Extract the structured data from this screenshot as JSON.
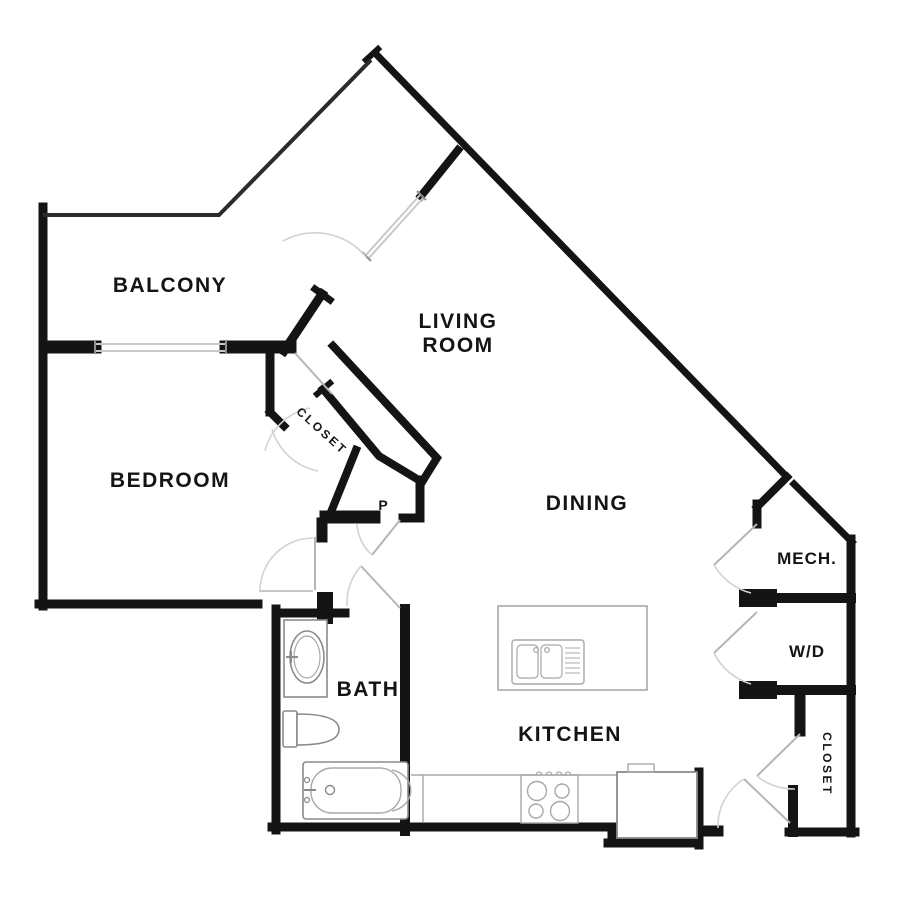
{
  "meta": {
    "kind": "apartment-floor-plan",
    "background_color": "#ffffff",
    "wall_color": "#141414",
    "door_color": "#c8c8c8",
    "window_color": "#c9c9c9",
    "fixture_color": "#8a8a8a",
    "label_color": "#141414"
  },
  "rooms": {
    "balcony": {
      "label": "BALCONY"
    },
    "living_room": {
      "label_line1": "LIVING",
      "label_line2": "ROOM"
    },
    "bedroom": {
      "label": "BEDROOM"
    },
    "hall_closet": {
      "label": "CLOSET"
    },
    "pantry": {
      "label": "P"
    },
    "dining": {
      "label": "DINING"
    },
    "mech": {
      "label": "MECH."
    },
    "laundry": {
      "label": "W/D"
    },
    "bath": {
      "label": "BATH"
    },
    "kitchen": {
      "label": "KITCHEN"
    },
    "right_closet": {
      "label": "CLOSET"
    }
  },
  "fixtures": {
    "bath_sink": "vanity with oval sink",
    "toilet": "toilet with tank",
    "bathtub": "bathtub with faucet",
    "kitchen_island": "island with double sink and drainboard",
    "kitchen_counter": "counter run",
    "stove": "4-burner range",
    "refrigerator": "refrigerator",
    "balcony_window": "window between bedroom and balcony",
    "entry_sidelight": "angled entry door panel"
  }
}
